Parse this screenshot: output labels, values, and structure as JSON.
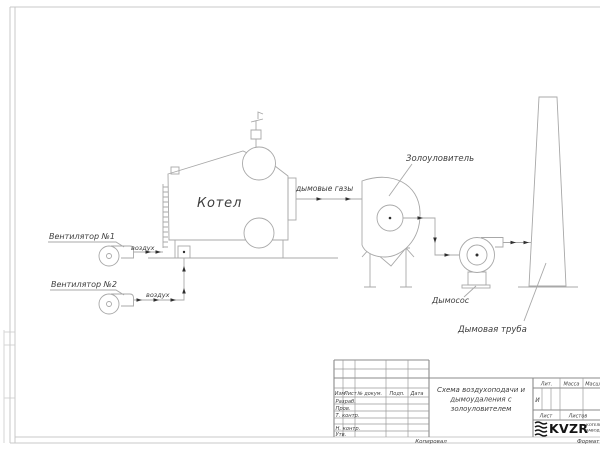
{
  "drawing": {
    "boiler_label": "Котел",
    "fan1_label": "Вентилятор №1",
    "fan2_label": "Вентилятор №2",
    "air_label_1": "воздух",
    "air_label_2": "воздух",
    "flue_gas_label": "дымовые газы",
    "ash_collector_label": "Золоуловитель",
    "smoke_exhauster_label": "Дымосос",
    "chimney_label": "Дымовая труба"
  },
  "title_block": {
    "columns": {
      "izm": "Изм",
      "list": "Лист",
      "doc": "№ докум.",
      "sign": "Подп.",
      "date": "Дата"
    },
    "rows": {
      "developed": "Разраб.",
      "checked": "Пров.",
      "t_control": "Т. контр.",
      "n_control": "Н. контр.",
      "approved": "Утв."
    },
    "title_line1": "Схема воздухоподачи и",
    "title_line2": "дымоудаления с",
    "title_line3": "золоуловителем",
    "lit_label": "Лит.",
    "lit_value": "И",
    "mass_label": "Масса",
    "scale_label": "Масшт",
    "sheet_label": "Лист",
    "sheets_label": "Листов",
    "logo": {
      "name": "KVZR",
      "sub_line1": "КОТЕЛЬН",
      "sub_line2": "ЗАВОД"
    },
    "copied_label": "Копировал",
    "format_label": "Формат"
  },
  "colors": {
    "drawing_line": "#a8a8a8",
    "frame_line": "#c9c9c9",
    "title_block_line": "#9b9b9b",
    "text": "#3e3e3e",
    "arrow": "#2f2f2f",
    "logo": "#141414",
    "background": "#ffffff"
  }
}
